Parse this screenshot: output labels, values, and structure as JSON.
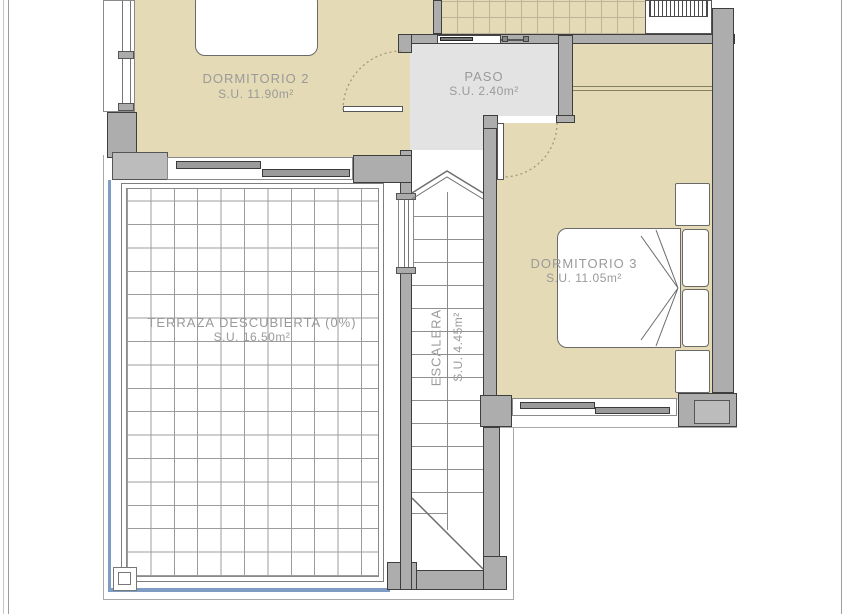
{
  "rooms": {
    "dormitorio2": {
      "label": "DORMITORIO 2",
      "area": "S.U. 11.90m²"
    },
    "paso": {
      "label": "PASO",
      "area": "S.U. 2.40m²"
    },
    "dormitorio3": {
      "label": "DORMITORIO 3",
      "area": "S.U. 11.05m²"
    },
    "terraza": {
      "label": "TERRAZA DESCUBIERTA (0%)",
      "area": "S.U. 16.50m²"
    },
    "escalera": {
      "label": "ESCALERA",
      "area": "S.U. 4.45m²"
    }
  },
  "palette": {
    "room_fill": "#e4dab5",
    "hall_fill": "#e3e3e3",
    "wall_fill": "#adadad",
    "wall_edge": "#3e3e3e",
    "label_color": "#9a9a9a",
    "terrace_blue": "#7f9dc4",
    "outline_gray": "#a8a8a8"
  }
}
